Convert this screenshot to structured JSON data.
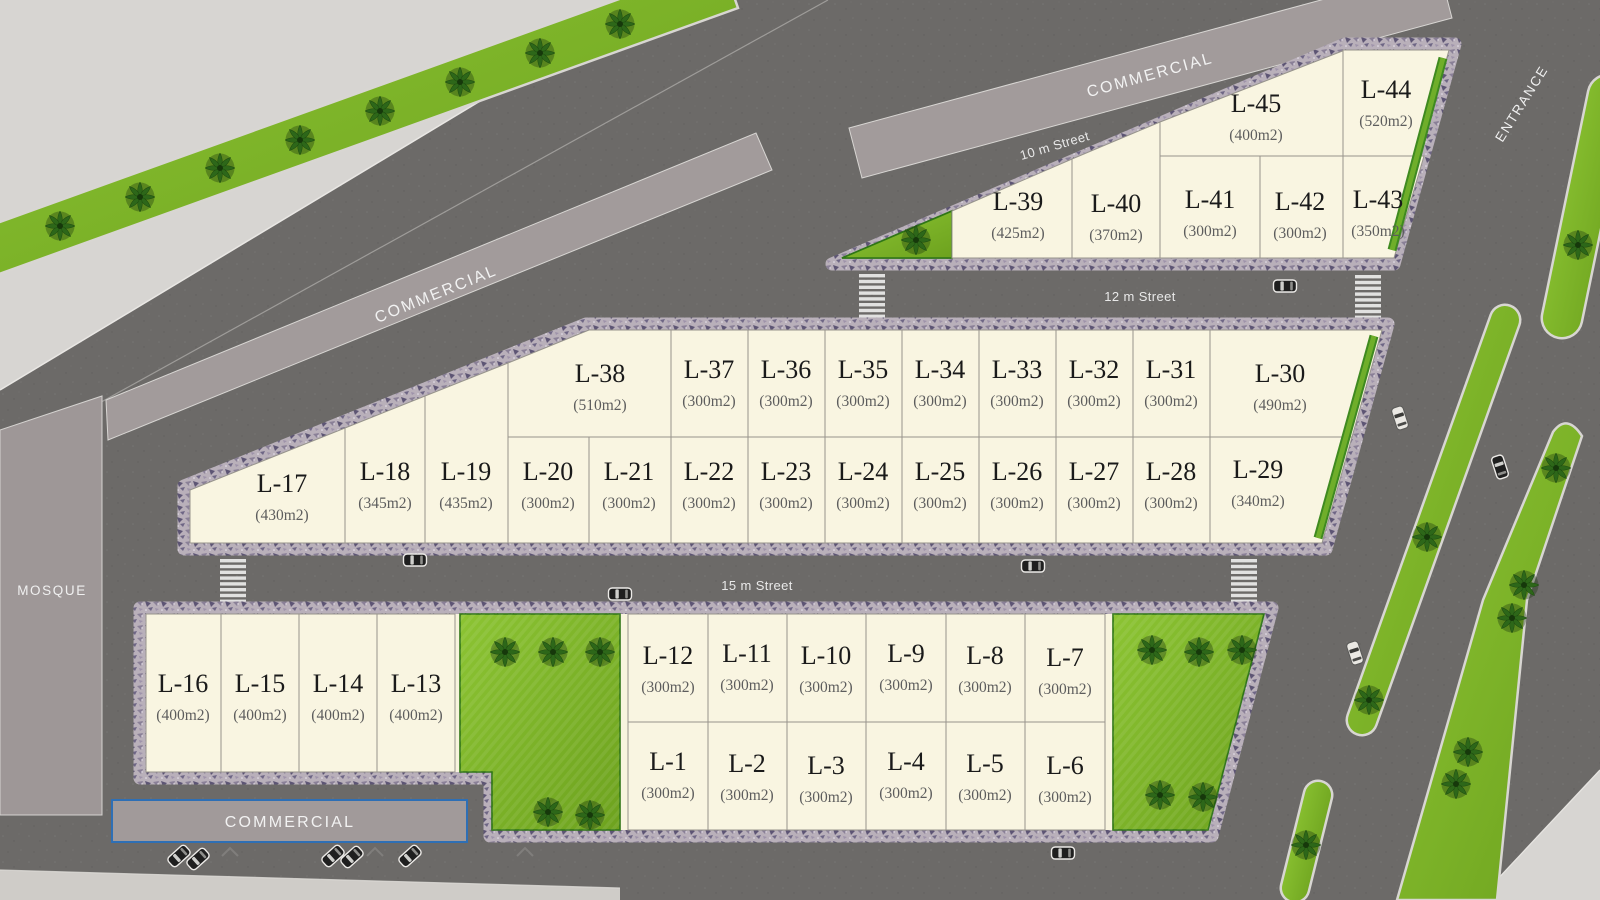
{
  "streets": {
    "ten": "10 m Street",
    "twelve": "12 m Street",
    "fifteen": "15 m Street"
  },
  "zones": {
    "commercial_top": "COMMERCIAL",
    "commercial_mid": "COMMERCIAL",
    "commercial_bottom": "COMMERCIAL",
    "mosque": "MOSQUE",
    "entrance": "ENTRANCE"
  },
  "colors": {
    "asphalt": "#6c6a68",
    "lot_fill": "#f9f5e1",
    "grass": "#7cb428",
    "sidewalk": "#b9b0ba",
    "building": "#a29b9b",
    "commercial_border": "#2e6fb5",
    "light_area": "#d7d5d2"
  },
  "lots": [
    {
      "name": "L-1",
      "area": "(300m2)"
    },
    {
      "name": "L-2",
      "area": "(300m2)"
    },
    {
      "name": "L-3",
      "area": "(300m2)"
    },
    {
      "name": "L-4",
      "area": "(300m2)"
    },
    {
      "name": "L-5",
      "area": "(300m2)"
    },
    {
      "name": "L-6",
      "area": "(300m2)"
    },
    {
      "name": "L-7",
      "area": "(300m2)"
    },
    {
      "name": "L-8",
      "area": "(300m2)"
    },
    {
      "name": "L-9",
      "area": "(300m2)"
    },
    {
      "name": "L-10",
      "area": "(300m2)"
    },
    {
      "name": "L-11",
      "area": "(300m2)"
    },
    {
      "name": "L-12",
      "area": "(300m2)"
    },
    {
      "name": "L-13",
      "area": "(400m2)"
    },
    {
      "name": "L-14",
      "area": "(400m2)"
    },
    {
      "name": "L-15",
      "area": "(400m2)"
    },
    {
      "name": "L-16",
      "area": "(400m2)"
    },
    {
      "name": "L-17",
      "area": "(430m2)"
    },
    {
      "name": "L-18",
      "area": "(345m2)"
    },
    {
      "name": "L-19",
      "area": "(435m2)"
    },
    {
      "name": "L-20",
      "area": "(300m2)"
    },
    {
      "name": "L-21",
      "area": "(300m2)"
    },
    {
      "name": "L-22",
      "area": "(300m2)"
    },
    {
      "name": "L-23",
      "area": "(300m2)"
    },
    {
      "name": "L-24",
      "area": "(300m2)"
    },
    {
      "name": "L-25",
      "area": "(300m2)"
    },
    {
      "name": "L-26",
      "area": "(300m2)"
    },
    {
      "name": "L-27",
      "area": "(300m2)"
    },
    {
      "name": "L-28",
      "area": "(300m2)"
    },
    {
      "name": "L-29",
      "area": "(340m2)"
    },
    {
      "name": "L-30",
      "area": "(490m2)"
    },
    {
      "name": "L-31",
      "area": "(300m2)"
    },
    {
      "name": "L-32",
      "area": "(300m2)"
    },
    {
      "name": "L-33",
      "area": "(300m2)"
    },
    {
      "name": "L-34",
      "area": "(300m2)"
    },
    {
      "name": "L-35",
      "area": "(300m2)"
    },
    {
      "name": "L-36",
      "area": "(300m2)"
    },
    {
      "name": "L-37",
      "area": "(300m2)"
    },
    {
      "name": "L-38",
      "area": "(510m2)"
    },
    {
      "name": "L-39",
      "area": "(425m2)"
    },
    {
      "name": "L-40",
      "area": "(370m2)"
    },
    {
      "name": "L-41",
      "area": "(300m2)"
    },
    {
      "name": "L-42",
      "area": "(300m2)"
    },
    {
      "name": "L-43",
      "area": "(350m2)"
    },
    {
      "name": "L-44",
      "area": "(520m2)"
    },
    {
      "name": "L-45",
      "area": "(400m2)"
    }
  ]
}
